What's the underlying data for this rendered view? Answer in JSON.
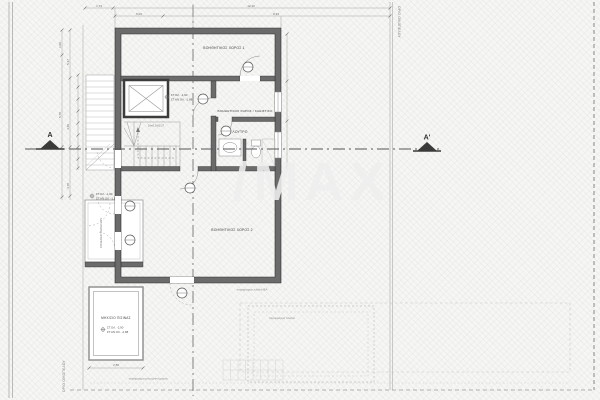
{
  "sheet": {
    "watermark": "/MAX",
    "boundary_right_label": "ΟΡΙΟ ΟΙΚΟΠΕΔΟΥ",
    "boundary_left_label": "ΟΡΙΟ ΟΙΚΟΠΕΔΟΥ"
  },
  "section": {
    "left": "A",
    "right": "A'"
  },
  "rooms": {
    "aux1": "ΒΟΗΘΗΤΙΚΟΣ ΧΩΡΟΣ 1",
    "aux_living": "ΒΟΗΘΗΤΙΚΟΣ ΧΩΡΟΣ / ΚΑΘΙΣΤΙΚΟ",
    "bath": "ΛΟΥΤΡΟ",
    "aux2": "ΒΟΗΘΗΤΙΚΟΣ ΧΩΡΟΣ 2",
    "pool_mech": "ΜΗΧ/ΣΙΟ ΠΙΣΙΝΑΣ",
    "pergola": "COVERED PERGOLAS"
  },
  "elevations": {
    "main_a": "ΣΤ.ΟΛ. -1,90",
    "main_b": "ΣΤ.ΑΝ.ΟΛ. -1,88",
    "terrace_a": "ΣΤ.ΟΛ. -1,90",
    "terrace_b": "ΣΤ.ΑΝ.ΟΛ. -1,88",
    "annex_a": "ΣΤ.ΟΛ. -2,90",
    "annex_b": "ΣΤ.ΑΝ.ΟΛ. -2,88"
  },
  "fence": {
    "side_ba": "περίφραγμα πλαϊνό ΒΑ",
    "side": "περίφραγμα πλαϊνό",
    "front": "περίφραγμα μπροστινή μεριά"
  },
  "dimensions": {
    "top1a": "1,73",
    "top1b": "12,10",
    "top2a": "5,03",
    "top2b": "8,23",
    "left1": "1,00",
    "left2": "5,70",
    "left3": "5,17",
    "left4": "4,40",
    "left5": "4,70",
    "annex_w": "2,50",
    "stair_note": "16×0,19/0,27"
  },
  "colors": {
    "wall": "#6b6b6b",
    "thin_line": "#999999",
    "axis": "#555555",
    "watermark": "#efefef"
  }
}
